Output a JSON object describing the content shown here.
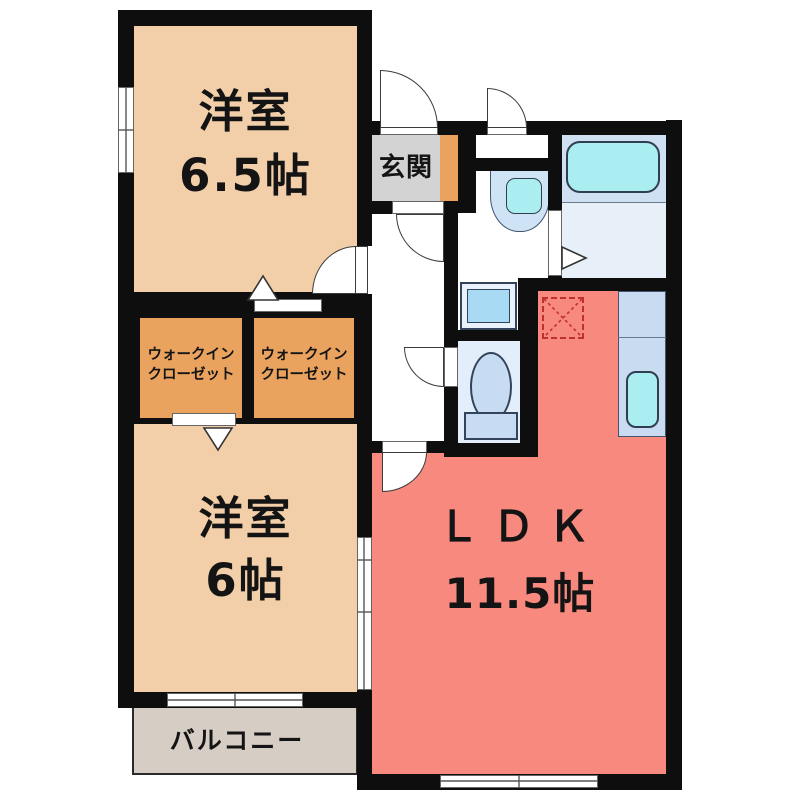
{
  "floorplan": {
    "rooms": {
      "western_room_top": {
        "name": "洋室",
        "size": "6.5帖"
      },
      "western_room_bottom": {
        "name": "洋室",
        "size": "6帖"
      },
      "ldk": {
        "name": "ＬＤＫ",
        "size": "11.5帖"
      },
      "entrance": {
        "name": "玄関"
      },
      "walk_in_closet_left": {
        "line1": "ウォークイン",
        "line2": "クローゼット"
      },
      "walk_in_closet_right": {
        "line1": "ウォークイン",
        "line2": "クローゼット"
      },
      "balcony": {
        "name": "バルコニー"
      }
    },
    "fixtures": [
      "bathtub",
      "washbasin",
      "washing-machine-pan",
      "toilet",
      "kitchen-counter",
      "kitchen-sink",
      "refrigerator-space"
    ],
    "colors": {
      "wall": "#0e0e0e",
      "room_peach": "#f2cfa9",
      "ldk_red": "#f8897f",
      "closet_orange": "#e9a35e",
      "entrance_gray": "#d3d3d3",
      "balcony_beige": "#d6cdc5",
      "bath_blue": "#cfe0f2",
      "water_cyan": "#abeef2",
      "fridge_dashed_red": "#c03030"
    }
  }
}
